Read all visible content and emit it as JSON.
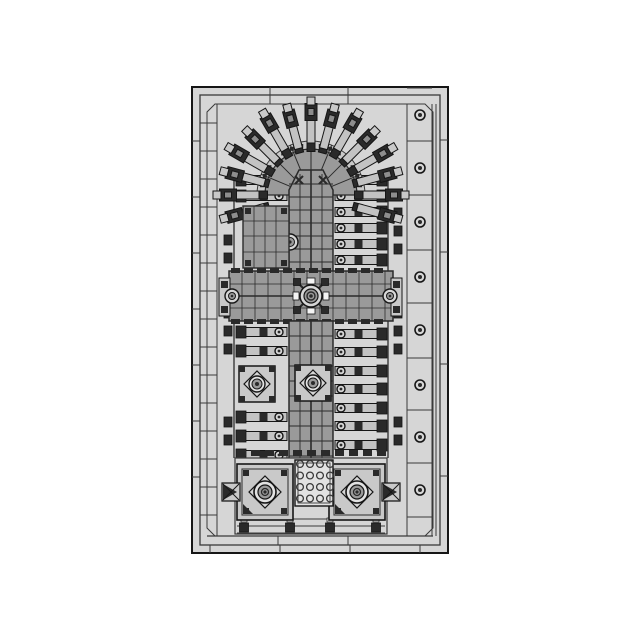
{
  "meta": {
    "subject": "cathedral-top-view-technical-drawing",
    "style": "monochrome-cad"
  },
  "canvas": {
    "width": 640,
    "height": 640,
    "background": "#ffffff"
  },
  "colors": {
    "plate": "#d6d6d6",
    "plate_dark": "#c9c9c9",
    "line": "#3a3a3a",
    "outline": "#161616",
    "roof": "#9a9a9a",
    "roof_line": "#2b2b2b",
    "bar": "#c3c3c3",
    "dark": "#2a2a2a",
    "mid": "#8d8d8d",
    "light": "#e2e2e2",
    "white": "#f4f4f4"
  },
  "baseplate": {
    "outer": {
      "x": 192,
      "y": 87,
      "w": 256,
      "h": 466
    },
    "band": 8,
    "inner_frame": {
      "x": 207,
      "y": 104,
      "w": 226,
      "h": 432,
      "chamfer": 8
    },
    "left_col_x": 217,
    "right_col": {
      "x1": 407,
      "x2": 432,
      "x3": 436
    },
    "top_ticks": [
      270,
      348
    ],
    "bottom_strip_y": 536,
    "bottom_strip_ticks": [
      278,
      348
    ],
    "bottom_band_ticks": [
      210,
      280,
      350,
      420
    ],
    "left_band_ticks": [
      141,
      197,
      253,
      309,
      365,
      421,
      477
    ],
    "right_band_ticks": [
      140,
      252,
      364,
      476
    ],
    "left_col_y0": 123,
    "left_col_step": 28,
    "studs": {
      "x": 420,
      "r_outer": 5,
      "r_inner": 2,
      "ys": [
        115,
        168,
        222,
        277,
        330,
        385,
        437,
        490
      ]
    }
  },
  "cathedral": {
    "axis_x": 311,
    "apse": {
      "cx": 311,
      "cy": 195,
      "disc_r": 46,
      "ring_r": 54,
      "ray_angles": [
        195,
        180,
        165,
        150,
        135,
        120,
        105,
        90,
        75,
        60,
        45,
        30,
        15,
        0,
        -15
      ],
      "ray": {
        "nub_r": 48,
        "bar_r": 62,
        "bar_l": 24,
        "bar_w": 8,
        "block_r": 81,
        "block_l": 17,
        "block_w": 12,
        "cap_r": 92,
        "cap_s": 8
      },
      "spoke_step": 22.5,
      "tick_r": 50,
      "tick_step": 11.25
    },
    "choir_roof": {
      "poly": [
        [
          289,
          272
        ],
        [
          289,
          190
        ],
        [
          299,
          170
        ],
        [
          323,
          170
        ],
        [
          333,
          190
        ],
        [
          333,
          272
        ]
      ],
      "v_lines": [
        300,
        322
      ],
      "ridge": 311,
      "h_lines": [
        184,
        197,
        210,
        223,
        236,
        249,
        262
      ],
      "x_marks": [
        [
          299,
          180
        ],
        [
          323,
          180
        ]
      ],
      "circle": {
        "cx": 290,
        "cy": 242
      }
    },
    "left_chapel": {
      "x": 243,
      "y": 206,
      "w": 46,
      "h": 62,
      "v_lines": [
        254,
        265,
        276
      ],
      "h_lines": [
        221,
        236,
        252
      ]
    },
    "choir_butt_left_ys": [
      180,
      196
    ],
    "choir_butt_right_ys": [
      180,
      196,
      212,
      228,
      244,
      260
    ],
    "transept": {
      "x": 229,
      "y": 271,
      "w": 164,
      "h": 50,
      "grid_step": 13,
      "h_lines": [
        284,
        308
      ],
      "mid": 296,
      "dash_rows": [
        268,
        319
      ],
      "end_caps": [
        [
          219,
          278
        ],
        [
          391,
          278
        ]
      ],
      "cross": {
        "cx": 311,
        "cy": 296,
        "arm": 17
      },
      "end_circles": [
        [
          232,
          296
        ],
        [
          390,
          296
        ]
      ]
    },
    "nave_roof": {
      "x": 289,
      "y": 321,
      "w": 44,
      "h": 149,
      "v_lines": [
        300,
        322
      ],
      "ridge": 311,
      "h0": 336,
      "h_step": 15,
      "h_count": 9
    },
    "nave_butt_left_ys": [
      332,
      351,
      417,
      436,
      455
    ],
    "nave_butt_right_ys": [
      334,
      352,
      371,
      389,
      408,
      426,
      445
    ],
    "flank": {
      "left_bar_x1": 240,
      "left_bar_x2": 287,
      "right_bar_x1": 335,
      "right_bar_x2": 382,
      "bar_h": 9,
      "circle_left_x": 279,
      "circle_right_x": 341,
      "circle_r": 4,
      "pier_left_x": 236,
      "pier_right_x": 377,
      "pier_w": 10,
      "pier_h": 12,
      "wall_left_x": 234,
      "wall_right_x": 388,
      "wall_y1": 172,
      "wall_y2": 458
    },
    "outer_blocks_left": {
      "x": 224,
      "ys": [
        240,
        258,
        295,
        313,
        331,
        349,
        422,
        440
      ]
    },
    "outer_blocks_right": {
      "x": 394,
      "ys": [
        213,
        231,
        249,
        295,
        313,
        331,
        349,
        422,
        440
      ]
    },
    "roof_squares": [
      {
        "cx": 257,
        "cy": 384,
        "s": 36
      },
      {
        "cx": 313,
        "cy": 383,
        "s": 36
      }
    ],
    "west": {
      "block": {
        "x": 235,
        "y": 458,
        "w": 152,
        "h": 76
      },
      "top_band": {
        "y": 450,
        "x1": 237,
        "x2": 385
      },
      "towers": [
        {
          "x": 237,
          "y": 464,
          "s": 56
        },
        {
          "x": 329,
          "y": 464,
          "s": 56
        }
      ],
      "pinnacles": [
        [
          231,
          492
        ],
        [
          391,
          492
        ]
      ],
      "portal": {
        "x": 295,
        "y": 460,
        "w": 38,
        "h": 46
      },
      "portal_studs": {
        "x0": 300,
        "y0": 464,
        "dx": 10,
        "dy": 11.5,
        "cols": 4,
        "rows": 4,
        "r": 3.4
      },
      "feet": {
        "y": 523,
        "xs": [
          244,
          290,
          330,
          376
        ],
        "w": 9,
        "h": 9
      },
      "base_lines": [
        519,
        526,
        533
      ]
    }
  }
}
